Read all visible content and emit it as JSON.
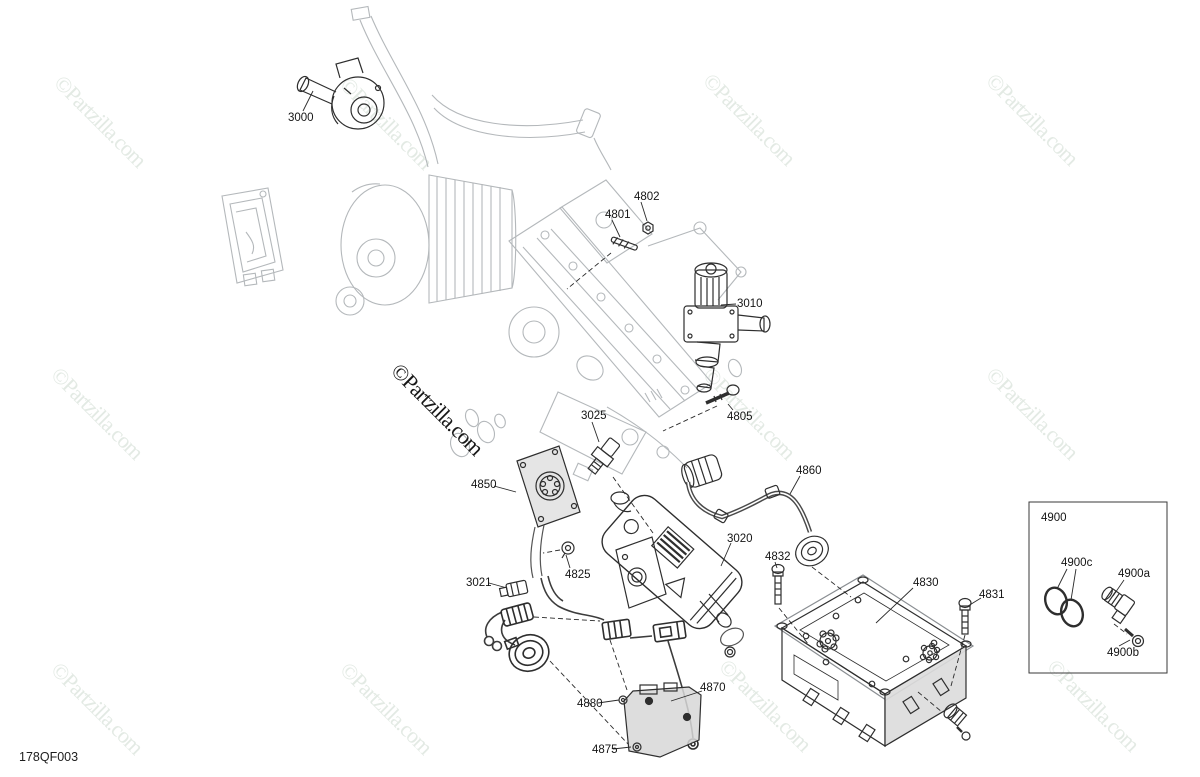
{
  "diagram": {
    "code": "178QF003",
    "watermark_text": "©Partzilla.com",
    "colors": {
      "background": "#ffffff",
      "watermark_light": "#e3eae4",
      "watermark_dark": "#181818",
      "line_light": "#b4b8bb",
      "line_dark": "#2e2e2e",
      "label_text": "#151515"
    },
    "labels": [
      {
        "text": "3000",
        "x": 288,
        "y": 112
      },
      {
        "text": "4802",
        "x": 634,
        "y": 191
      },
      {
        "text": "4801",
        "x": 605,
        "y": 209
      },
      {
        "text": "3010",
        "x": 737,
        "y": 298
      },
      {
        "text": "4805",
        "x": 727,
        "y": 411
      },
      {
        "text": "3025",
        "x": 581,
        "y": 410
      },
      {
        "text": "4850",
        "x": 471,
        "y": 479
      },
      {
        "text": "4860",
        "x": 796,
        "y": 465
      },
      {
        "text": "3020",
        "x": 727,
        "y": 533
      },
      {
        "text": "4832",
        "x": 765,
        "y": 551
      },
      {
        "text": "4825",
        "x": 565,
        "y": 569
      },
      {
        "text": "3021",
        "x": 466,
        "y": 577
      },
      {
        "text": "4830",
        "x": 913,
        "y": 577
      },
      {
        "text": "4831",
        "x": 979,
        "y": 589
      },
      {
        "text": "4880",
        "x": 577,
        "y": 698
      },
      {
        "text": "4870",
        "x": 700,
        "y": 682
      },
      {
        "text": "4875",
        "x": 592,
        "y": 744
      },
      {
        "text": "4900",
        "x": 1041,
        "y": 512
      },
      {
        "text": "4900c",
        "x": 1061,
        "y": 557
      },
      {
        "text": "4900a",
        "x": 1118,
        "y": 568
      },
      {
        "text": "4900b",
        "x": 1107,
        "y": 647
      }
    ],
    "watermarks": [
      {
        "x": 67,
        "y": 70,
        "variant": "light"
      },
      {
        "x": 353,
        "y": 72,
        "variant": "light"
      },
      {
        "x": 716,
        "y": 68,
        "variant": "light"
      },
      {
        "x": 999,
        "y": 68,
        "variant": "light"
      },
      {
        "x": 64,
        "y": 362,
        "variant": "light"
      },
      {
        "x": 404,
        "y": 358,
        "variant": "dark"
      },
      {
        "x": 716,
        "y": 362,
        "variant": "light"
      },
      {
        "x": 999,
        "y": 362,
        "variant": "light"
      },
      {
        "x": 64,
        "y": 657,
        "variant": "light"
      },
      {
        "x": 353,
        "y": 657,
        "variant": "light"
      },
      {
        "x": 732,
        "y": 654,
        "variant": "light"
      },
      {
        "x": 1060,
        "y": 654,
        "variant": "light"
      }
    ]
  }
}
